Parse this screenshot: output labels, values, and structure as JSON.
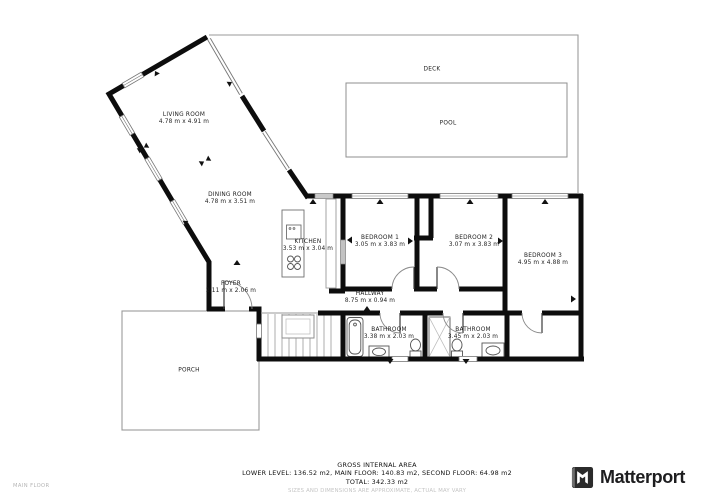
{
  "floorplan": {
    "floor_label": "MAIN FLOOR",
    "rooms": [
      {
        "name": "LIVING ROOM",
        "dims": "4.78 m x 4.91 m"
      },
      {
        "name": "DINING ROOM",
        "dims": "4.78 m x 3.51 m"
      },
      {
        "name": "KITCHEN",
        "dims": "3.53 m x 3.04 m"
      },
      {
        "name": "FOYER",
        "dims": "2.11 m x 2.06 m"
      },
      {
        "name": "BEDROOM 1",
        "dims": "3.05 m x 3.83 m"
      },
      {
        "name": "BEDROOM 2",
        "dims": "3.07 m x 3.83 m"
      },
      {
        "name": "BEDROOM 3",
        "dims": "4.95 m x 4.88 m"
      },
      {
        "name": "HALLWAY",
        "dims": "8.75 m x 0.94 m"
      },
      {
        "name": "BATHROOM",
        "dims": "3.38 m x 2.03 m"
      },
      {
        "name": "BATHROOM",
        "dims": "3.45 m x 2.03 m"
      },
      {
        "name": "DECK",
        "dims": ""
      },
      {
        "name": "POOL",
        "dims": ""
      },
      {
        "name": "PORCH",
        "dims": ""
      }
    ]
  },
  "footer": {
    "title": "GROSS INTERNAL AREA",
    "line1": "LOWER LEVEL: 136.52 m2, MAIN FLOOR: 140.83 m2, SECOND FLOOR: 64.98 m2",
    "line2": "TOTAL: 342.33 m2",
    "disclaimer": "SIZES AND DIMENSIONS ARE APPROXIMATE, ACTUAL MAY VARY"
  },
  "brand": {
    "name": "Matterport"
  },
  "colors": {
    "wall": "#0d0d0d",
    "outline": "#999999",
    "text": "#1c1c1c",
    "muted": "#c4c4c4"
  }
}
